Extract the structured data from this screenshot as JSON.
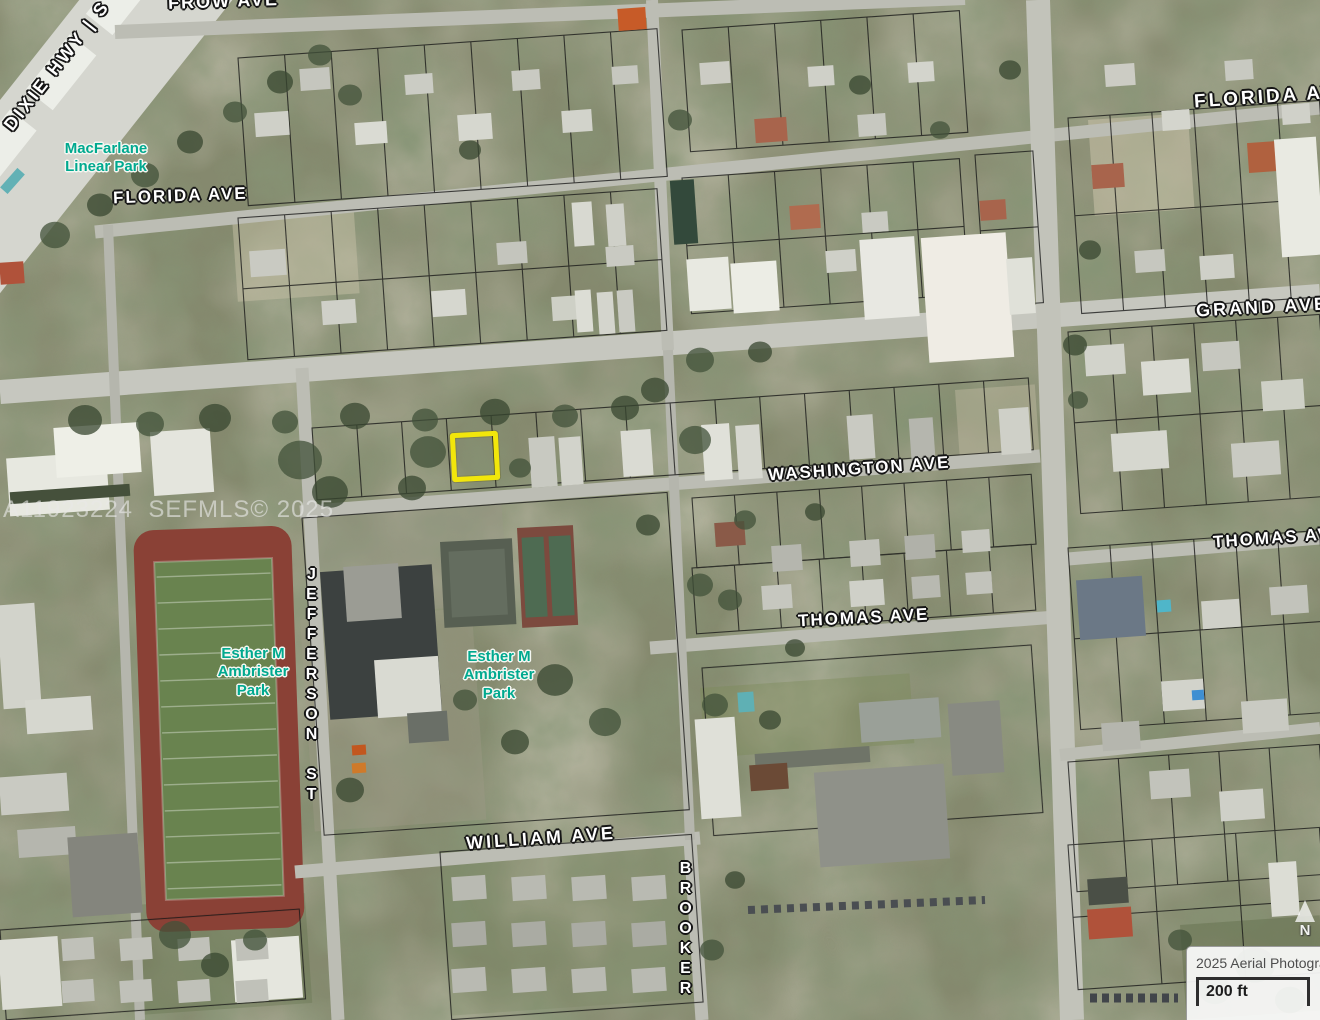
{
  "map": {
    "streets": {
      "frow": "FROW AVE",
      "dixie_hwy": "DIXIE HWY | S",
      "florida_left": "FLORIDA AVE",
      "florida_right": "FLORIDA AVE",
      "grand": "GRAND AVE",
      "washington": "WASHINGTON AVE",
      "thomas_mid": "THOMAS AVE",
      "thomas_right": "THOMAS AVE",
      "william": "WILLIAM AVE",
      "jefferson": "JEFFERSON ST",
      "brooker": "BROOKER ST"
    },
    "parks": {
      "macfarlane": "MacFarlane\nLinear Park",
      "ambrister_west": "Esther M\nAmbrister\nPark",
      "ambrister_east": "Esther M\nAmbrister\nPark"
    },
    "watermark": "A11923224  SEFMLS© 2025",
    "north_indicator": "N",
    "attribution": {
      "label": "2025 Aerial Photography",
      "scale_label": "200 ft"
    },
    "highlight": {
      "color": "#F2E60B"
    }
  },
  "colors": {
    "street_label": "#FFFFFF",
    "park_label": "#00A98F",
    "highlight_yellow": "#F2E60B",
    "parcel_line": "#171717",
    "road": "#BCBDB4"
  }
}
